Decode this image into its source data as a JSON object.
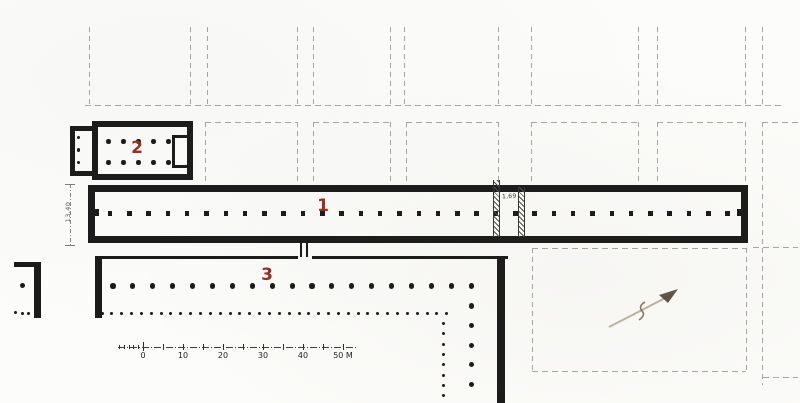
{
  "plan": {
    "title_labels": {
      "building_1": "1",
      "building_2": "2",
      "building_3": "3"
    },
    "dimensions": {
      "stoa_depth": "13,40",
      "cross_wall": "1,69"
    },
    "scale_bar": {
      "tick_labels": [
        "0",
        "10",
        "20",
        "30",
        "40"
      ],
      "end_label": "50 M"
    },
    "colors": {
      "ink": "#1a1a1a",
      "street_dash": "#a6a6a6",
      "label_red": "#9e2a1b",
      "pencil": "#b3a895"
    },
    "colonnades": {
      "stoa_1_columns": 33,
      "building_2_interior_rows": 2,
      "building_2_columns_per_row": 5,
      "building_2_porch_columns": 3,
      "building_3_inner_colonnade": 19,
      "building_3_inner_colonnade_south_wing": 5,
      "building_3_outer_colonnade": 36,
      "building_3_outer_colonnade_south_wing": 8,
      "west_fragment_columns": 1,
      "west_fragment_small_columns": 3
    }
  }
}
